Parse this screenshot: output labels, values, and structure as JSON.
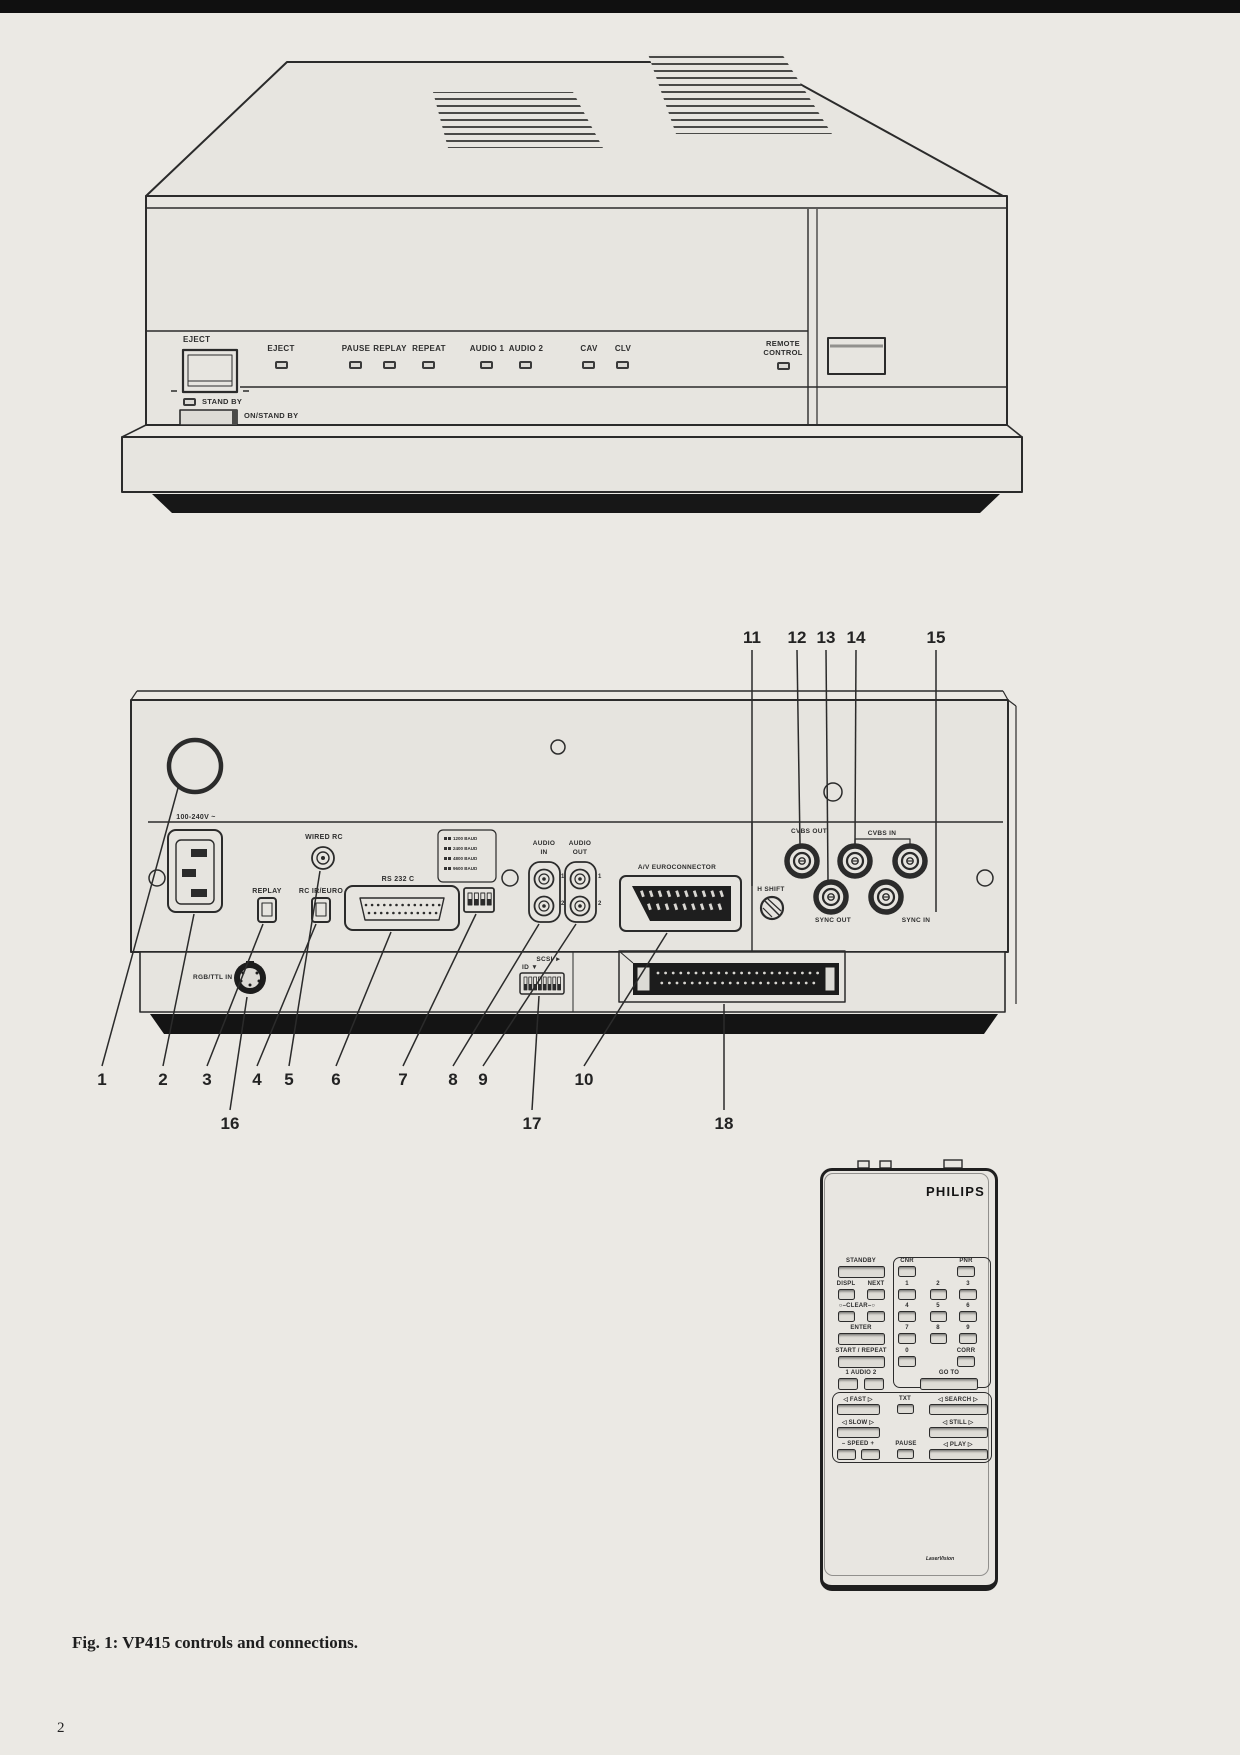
{
  "page": {
    "caption": "Fig. 1: VP415 controls and connections.",
    "page_number": "2"
  },
  "front_panel": {
    "eject_button_label": "EJECT",
    "indicators": [
      {
        "label": "EJECT"
      },
      {
        "label": "PAUSE"
      },
      {
        "label": "REPLAY"
      },
      {
        "label": "REPEAT"
      },
      {
        "label": "AUDIO 1"
      },
      {
        "label": "AUDIO 2"
      },
      {
        "label": "CAV"
      },
      {
        "label": "CLV"
      },
      {
        "label": "REMOTE CONTROL"
      }
    ],
    "standby_label": "STAND BY",
    "on_standby_label": "ON/STAND BY"
  },
  "rear_panel": {
    "power_label": "100-240V ~",
    "wired_rc_label": "WIRED RC",
    "replay_label": "REPLAY",
    "rc_ir_euro_label": "RC IR/EURO",
    "rs232c_label": "RS 232 C",
    "baud_legend": [
      "1200 BAUD",
      "2400 BAUD",
      "4800 BAUD",
      "9600 BAUD"
    ],
    "audio_in_label_1": "AUDIO",
    "audio_in_label_2": "IN",
    "audio_out_label_1": "AUDIO",
    "audio_out_label_2": "OUT",
    "jack_1": "1",
    "jack_2": "2",
    "euroconnector_label": "A/V EUROCONNECTOR",
    "h_shift_label": "H SHIFT",
    "cvbs_out_label": "CVBS OUT",
    "cvbs_in_label": "CVBS IN",
    "sync_out_label": "SYNC OUT",
    "sync_in_label": "SYNC IN",
    "rgb_ttl_in_label": "RGB/TTL IN",
    "scsi_label": "SCSI ►",
    "scsi_id_label": "ID ▼"
  },
  "callouts": {
    "top": [
      "11",
      "12",
      "13",
      "14",
      "15"
    ],
    "bottom": [
      "1",
      "2",
      "3",
      "4",
      "5",
      "6",
      "7",
      "8",
      "9",
      "10"
    ],
    "lower": [
      "16",
      "17",
      "18"
    ]
  },
  "remote": {
    "brand": "PHILIPS",
    "standby": "STANDBY",
    "cnr": "CNR",
    "pnr": "PNR",
    "displ": "DISPL",
    "next": "NEXT",
    "clear": "○–CLEAR–○",
    "digits": [
      "1",
      "2",
      "3",
      "4",
      "5",
      "6",
      "7",
      "8",
      "9"
    ],
    "zero": "0",
    "enter": "ENTER",
    "start_repeat": "START / REPEAT",
    "corr": "CORR",
    "audio": "1  AUDIO  2",
    "goto_label": "GO TO",
    "fast": "◁ FAST ▷",
    "txt": "TXT",
    "search": "◁ SEARCH ▷",
    "slow": "◁ SLOW ▷",
    "still": "◁ STILL ▷",
    "speed": "– SPEED +",
    "pause": "PAUSE",
    "play": "◁ PLAY ▷",
    "laservision": "LaserVision"
  }
}
